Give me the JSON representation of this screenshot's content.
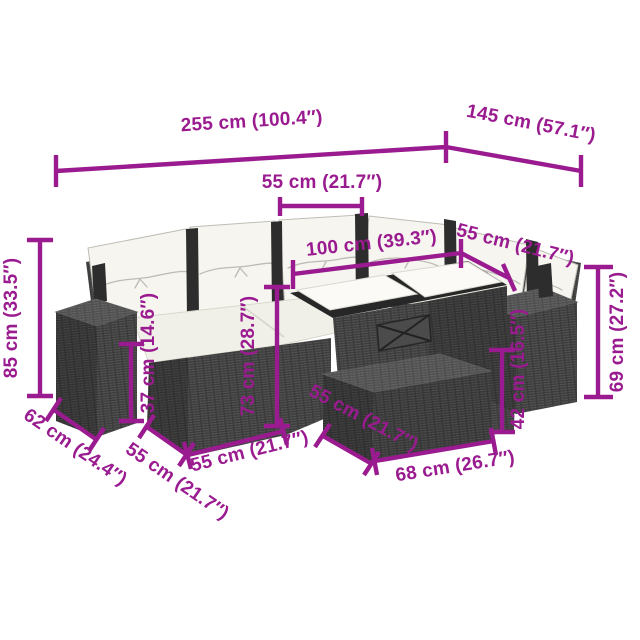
{
  "meta": {
    "accent_color": "#9A1B8F",
    "background_color": "#FFFFFF",
    "wicker_color": "#3C3C3C",
    "cushion_color": "#F4F3ED"
  },
  "diagram": {
    "type": "product-dimension-diagram",
    "furniture": {
      "description": "7-piece dark poly rattan corner garden lounge set with white back pillows and seat cushions, glass-top table, ottoman and two cube side boxes"
    },
    "dims": {
      "d255": {
        "label": "255 cm (100.4″)"
      },
      "d145": {
        "label": "145 cm (57.1″)"
      },
      "d55_top": {
        "label": "55 cm (21.7″)"
      },
      "d100": {
        "label": "100 cm (39.3″)"
      },
      "d55_right": {
        "label": "55 cm (21.7″)"
      },
      "d85": {
        "label": "85 cm (33.5″)"
      },
      "d37": {
        "label": "37 cm (14.6″)"
      },
      "d73": {
        "label": "73 cm (28.7″)"
      },
      "d69": {
        "label": "69 cm (27.2″)"
      },
      "d42": {
        "label": "42 cm (16.5″)"
      },
      "d62": {
        "label": "62 cm (24.4″)"
      },
      "d55_left": {
        "label": "55 cm (21.7″)"
      },
      "d55_front": {
        "label": "55 cm (21.7″)"
      },
      "d55_ottoman": {
        "label": "55 cm (21.7″)"
      },
      "d68": {
        "label": "68 cm (26.7″)"
      }
    }
  }
}
